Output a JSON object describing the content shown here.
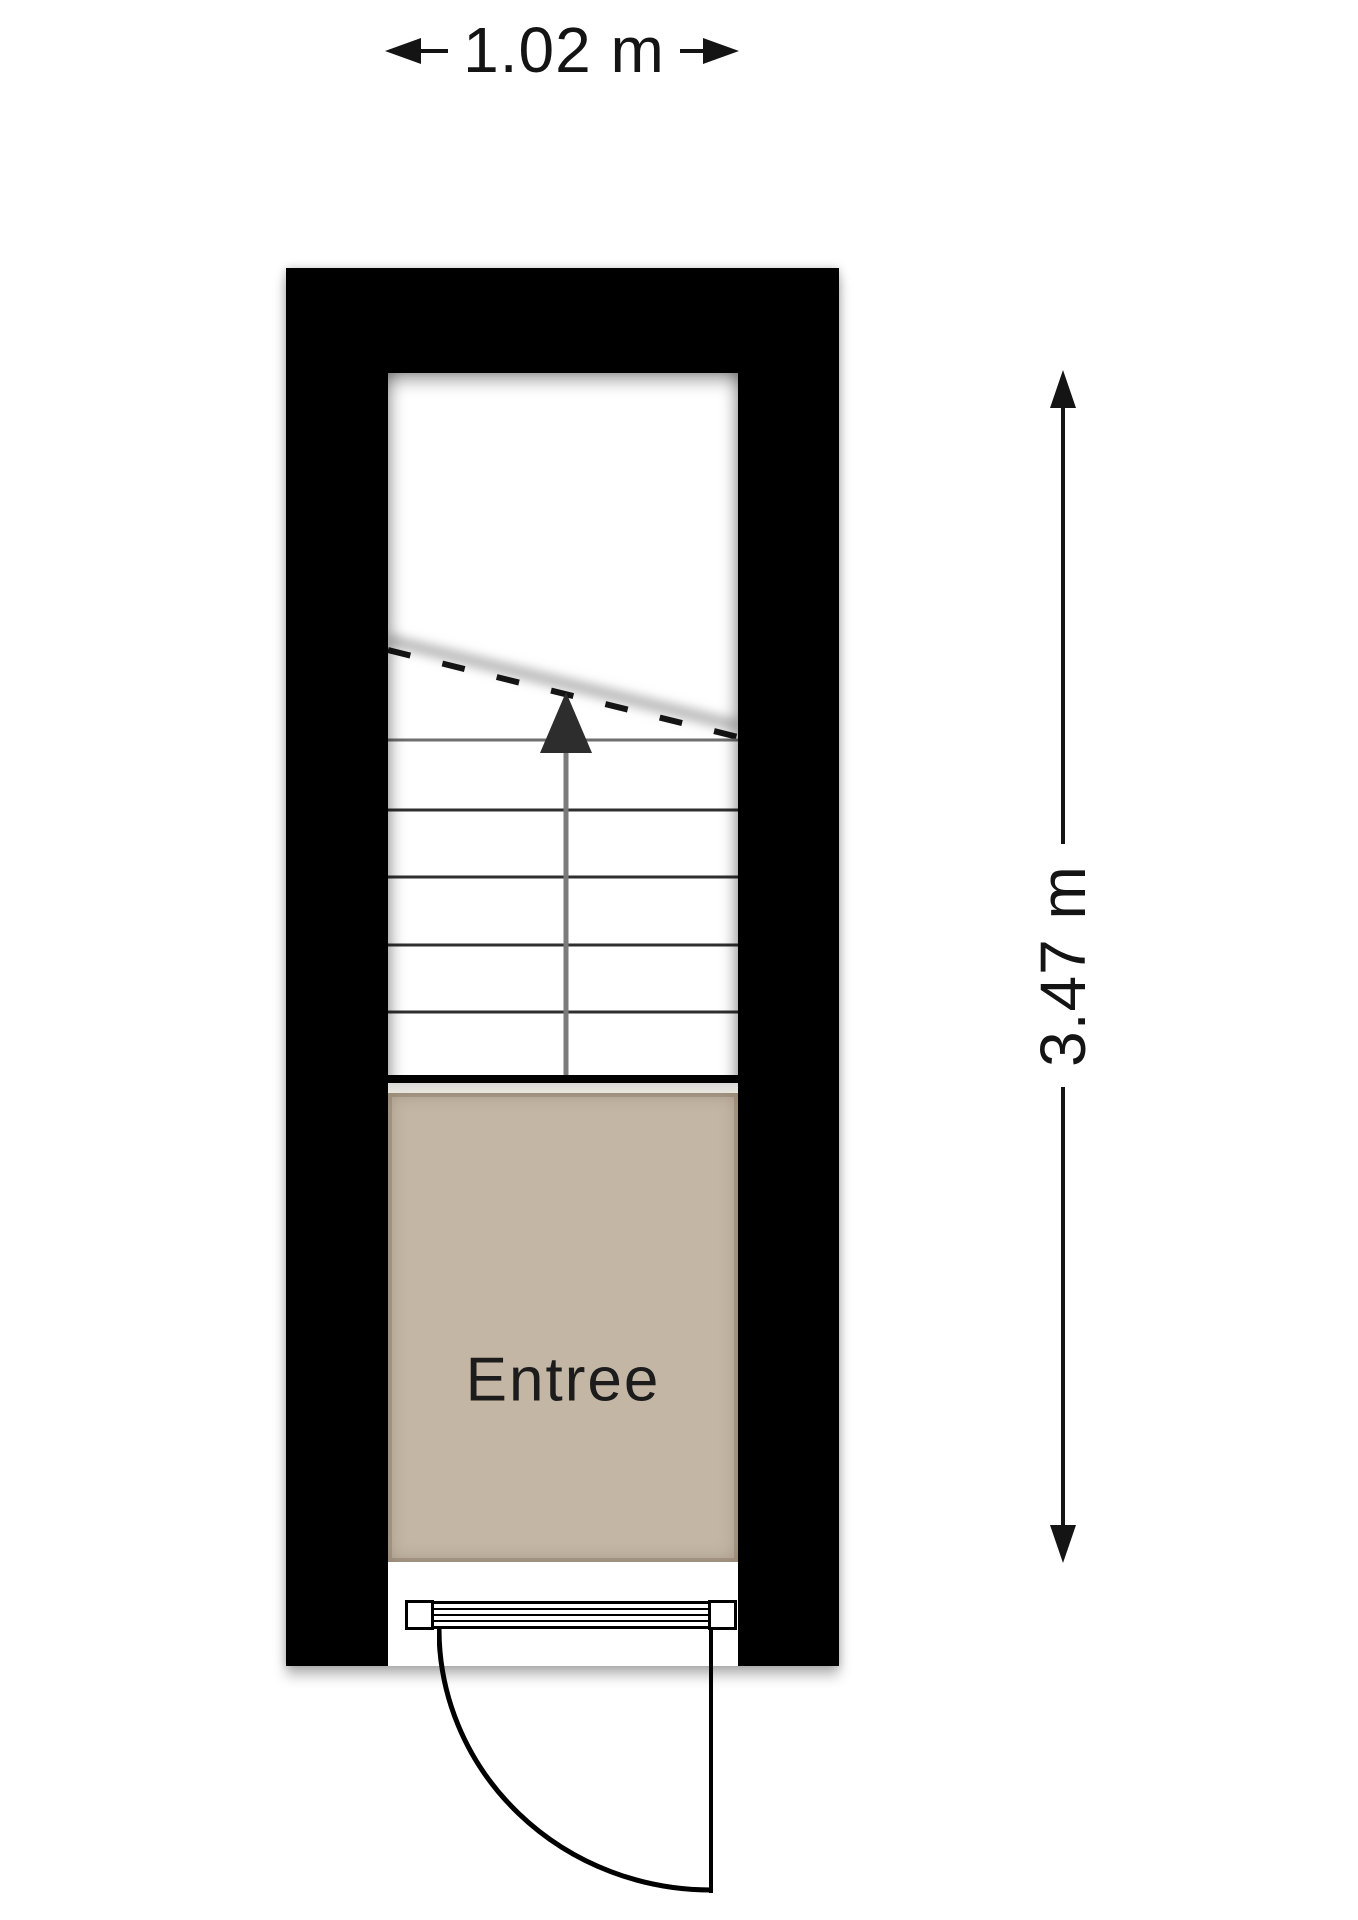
{
  "colors": {
    "wall": "#000000",
    "floor": "#c3b6a4",
    "ink": "#141414",
    "shaft": "#7b7b7b",
    "head": "#2d2d2d"
  },
  "plan": {
    "room": {
      "label": "Entree"
    },
    "dimensions": {
      "horizontal": {
        "label": "1.02 m",
        "position": "top"
      },
      "vertical": {
        "label": "3.47 m",
        "position": "right"
      }
    },
    "stairs": {
      "direction": "up",
      "tread_lines": 5,
      "cut_line": "dashed"
    },
    "door": {
      "type": "single-swing",
      "hinge": "right",
      "swing": "outward"
    }
  }
}
